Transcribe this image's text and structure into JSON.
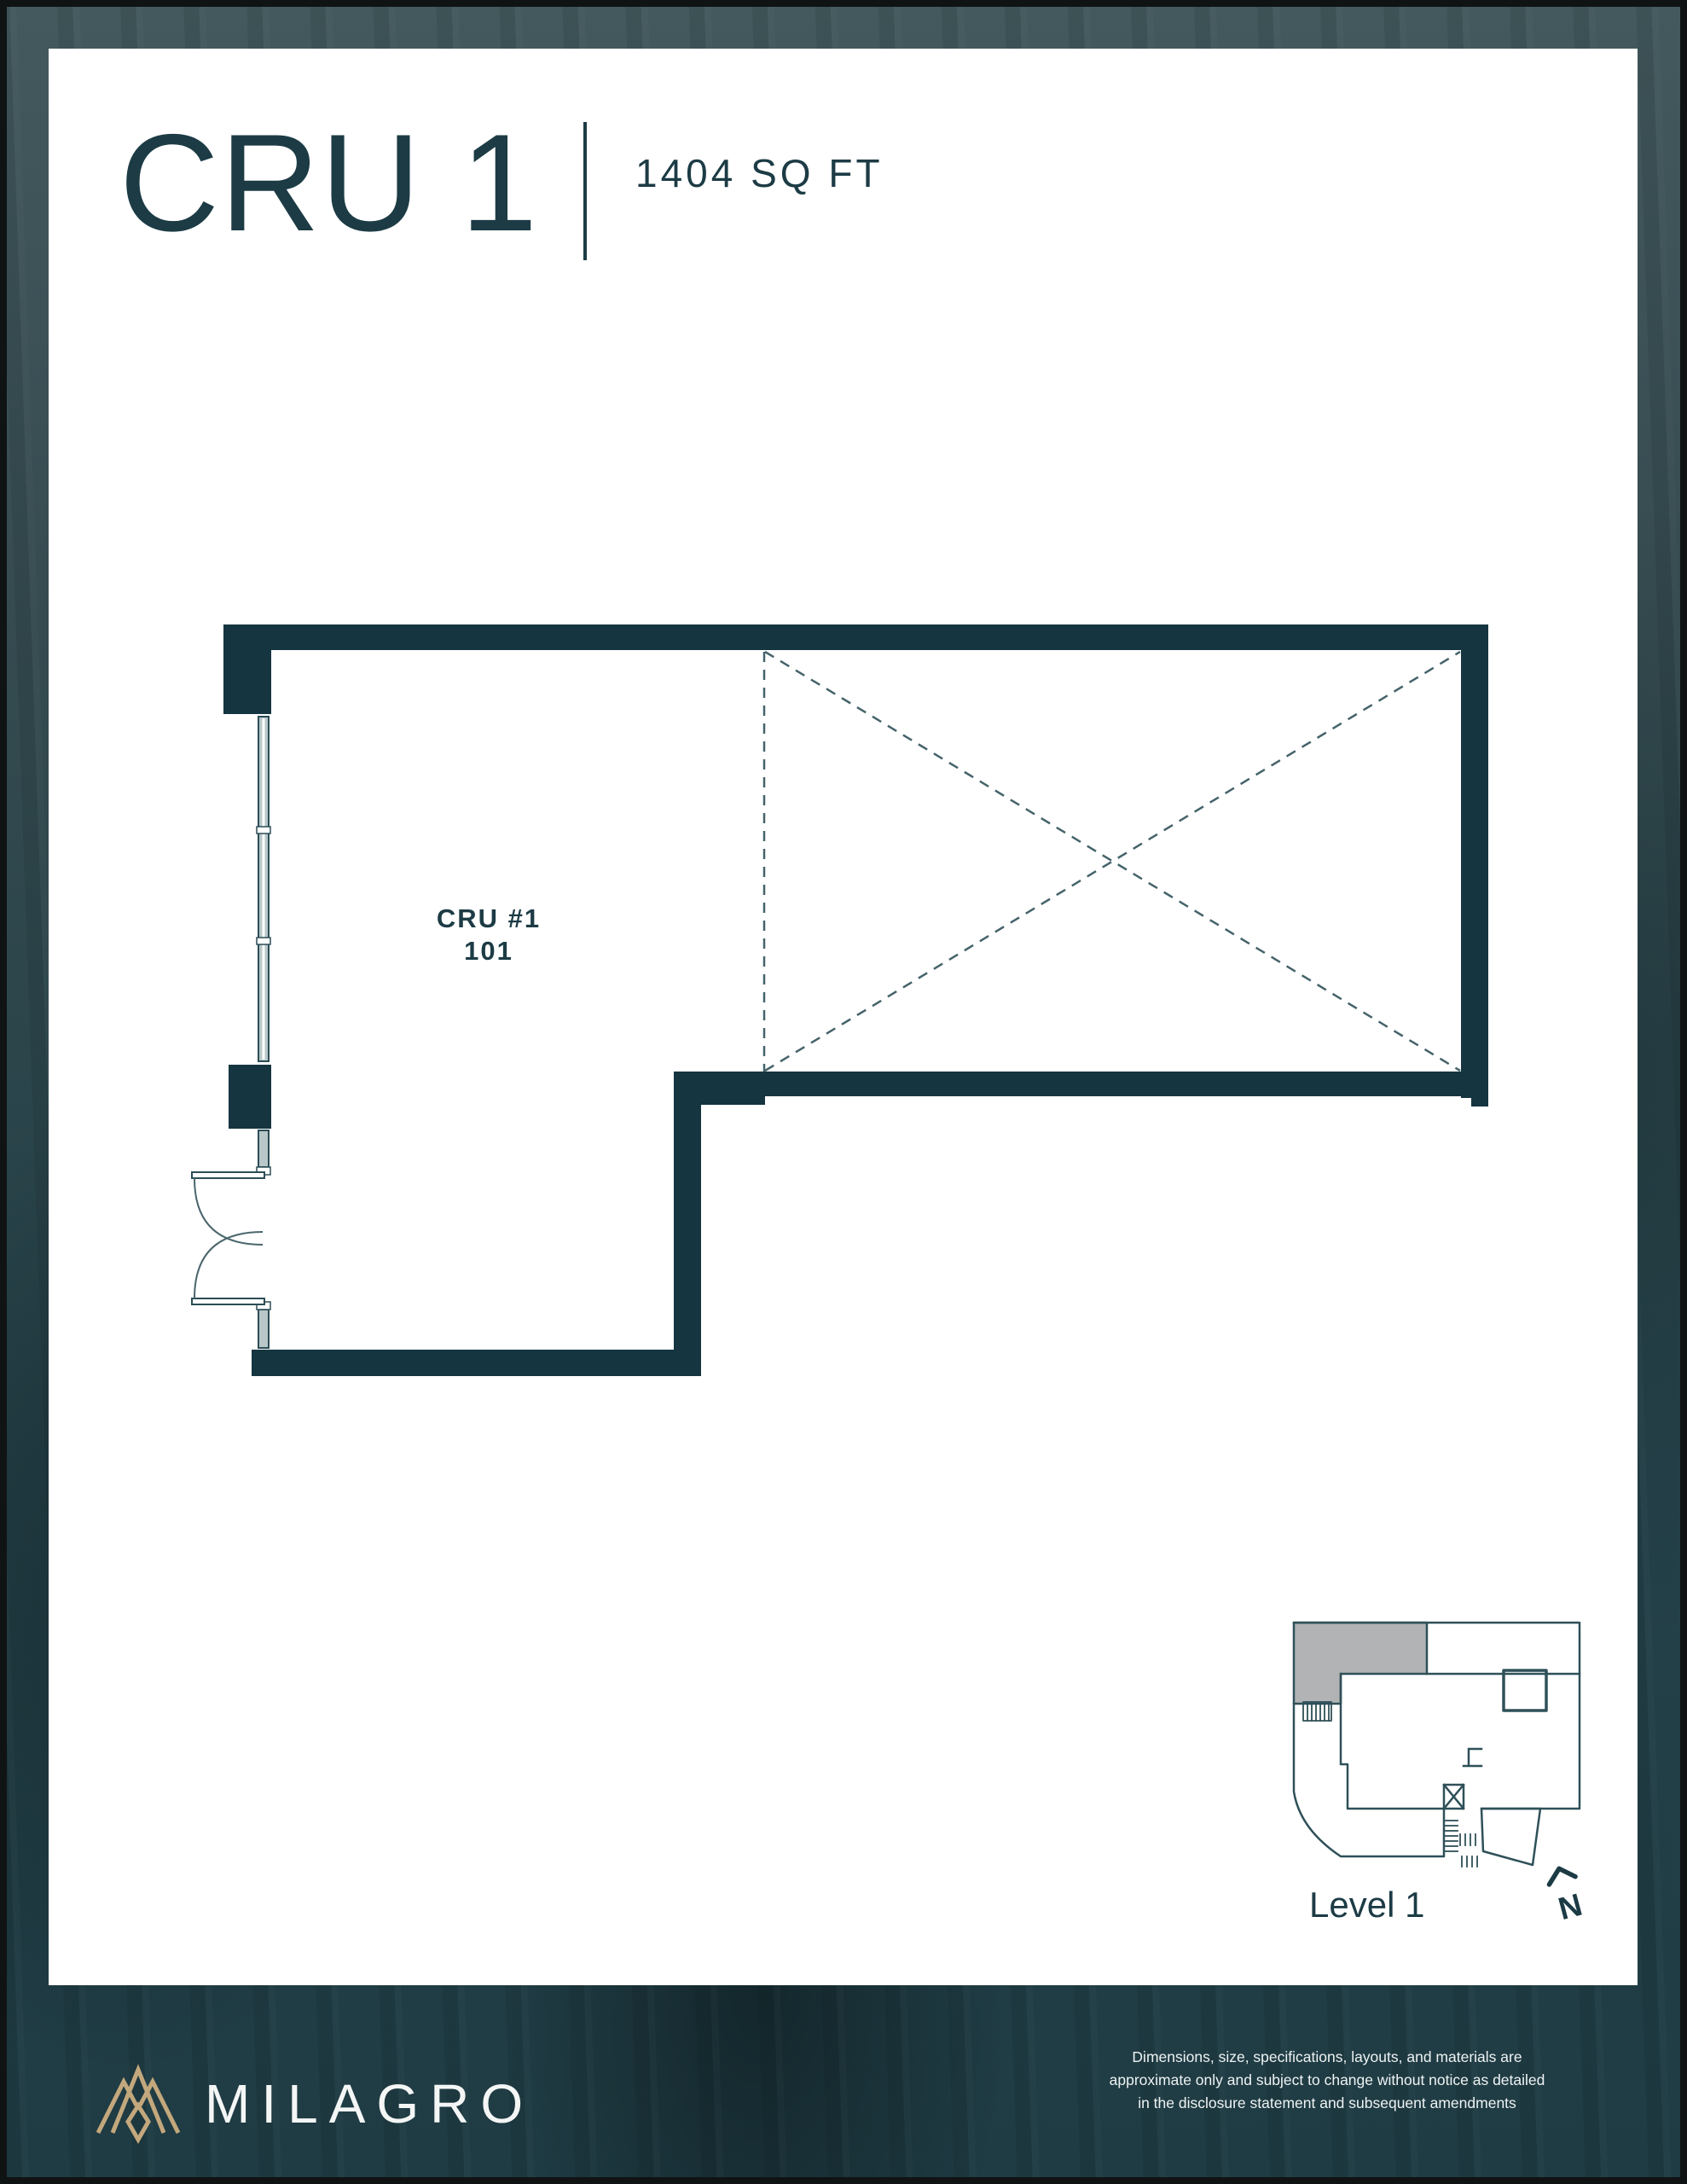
{
  "header": {
    "title": "CRU 1",
    "area": "1404 SQ FT"
  },
  "plan": {
    "unit_name": "CRU #1",
    "unit_number": "101"
  },
  "locator": {
    "level": "Level 1",
    "north": "N"
  },
  "footer": {
    "brand": "MILAGRO",
    "disclaimer_lines": [
      "Dimensions, size, specifications, layouts, and materials are",
      "approximate only and subject to change without notice as detailed",
      "in the disclosure statement and subsequent amendments"
    ]
  },
  "colors": {
    "accent": "#1c3b45",
    "wall": "#153540",
    "dash": "#45636a",
    "window_fill": "#b9c7c9",
    "logo_gold": "#c3a87d",
    "map_stroke": "#2f5058",
    "map_highlight": "#b1b3b4",
    "page_bg": "#ffffff",
    "backdrop": "#2c474d"
  }
}
